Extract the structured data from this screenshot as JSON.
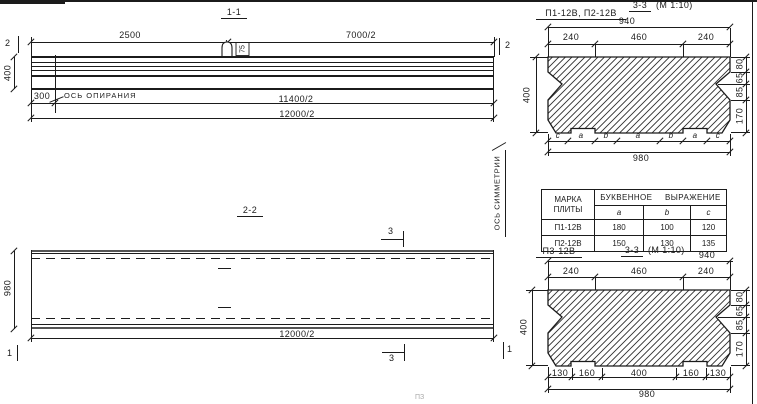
{
  "drawing": {
    "frame_color": "#1b1b1b",
    "section_1_1": {
      "title": "1-1",
      "marker_2": "2",
      "dim_2500": "2500",
      "dim_7000_half": "7000/2",
      "dim_400": "400",
      "dim_300": "300",
      "support_axis_label": "ОСЬ ОПИРАНИЯ",
      "dim_11400_half": "11400/2",
      "dim_12000_half": "12000/2",
      "loop_mark": "75",
      "symmetry_axis_label": "ОСЬ СИММЕТРИИ"
    },
    "section_2_2": {
      "title": "2-2",
      "marker_3": "3",
      "marker_1": "1",
      "dim_980": "980",
      "dim_12000_half": "12000/2"
    },
    "section_3_3_top": {
      "title": "3-3",
      "scale": "(М 1:10)",
      "plates_label": "П1-12В, П2-12В",
      "dim_940": "940",
      "dim_240_left": "240",
      "dim_460": "460",
      "dim_240_right": "240",
      "dim_400": "400",
      "dim_80": "80",
      "dim_65": "65",
      "dim_85": "85",
      "dim_170": "170",
      "dim_980": "980",
      "letters": [
        "c",
        "a",
        "b",
        "a",
        "b",
        "a",
        "c"
      ]
    },
    "table": {
      "header_mark": "МАРКА ПЛИТЫ",
      "header_expression": "БУКВЕННОЕ ВЫРАЖЕНИЕ",
      "sub_headers": [
        "a",
        "b",
        "c"
      ],
      "rows": [
        {
          "mark": "П1-12В",
          "a": "180",
          "b": "100",
          "c": "120"
        },
        {
          "mark": "П2-12В",
          "a": "150",
          "b": "130",
          "c": "135"
        }
      ]
    },
    "section_3_3_bottom": {
      "plate_label": "П3-12В",
      "title": "3-3",
      "scale": "(М 1:10)",
      "dim_940": "940",
      "dim_240_left": "240",
      "dim_460": "460",
      "dim_240_right": "240",
      "dim_400": "400",
      "dim_80": "80",
      "dim_65": "65",
      "dim_85": "85",
      "dim_170": "170",
      "dim_130_left": "130",
      "dim_160_left": "160",
      "dim_400_bottom": "400",
      "dim_160_right": "160",
      "dim_130_right": "130",
      "dim_980": "980"
    },
    "artifact_text": "ПЗ"
  }
}
